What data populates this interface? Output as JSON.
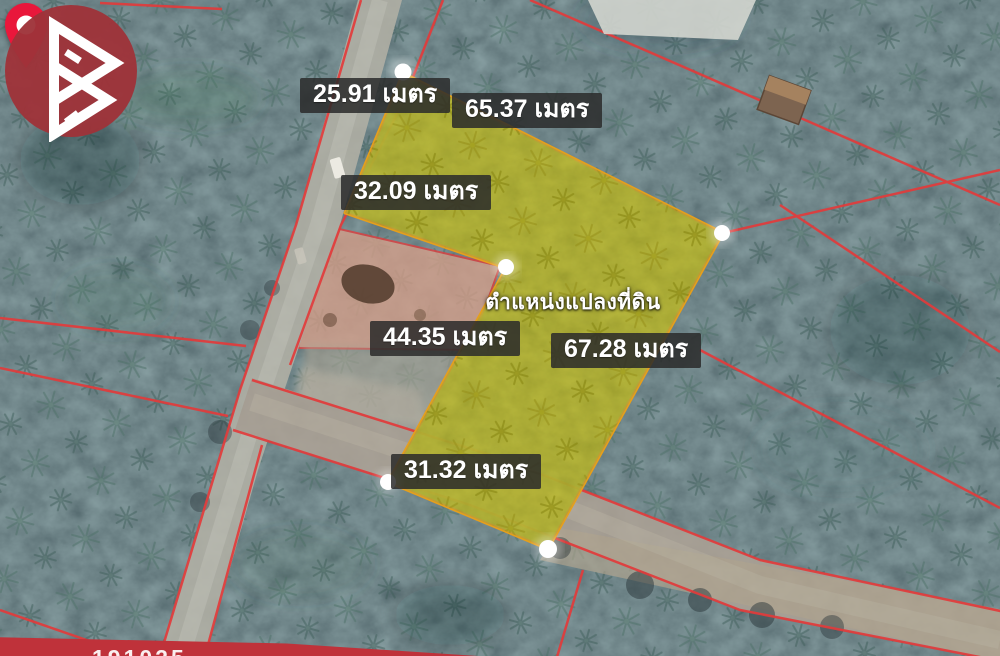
{
  "map": {
    "type_note": "satellite view of palm plantation with surveyed land plot overlay",
    "measurements": [
      {
        "edge": "upper-road-frontage",
        "text": "25.91 เมตร",
        "value": 25.91,
        "unit": "เมตร"
      },
      {
        "edge": "top-right",
        "text": "65.37 เมตร",
        "value": 65.37,
        "unit": "เมตร"
      },
      {
        "edge": "mid-road-frontage",
        "text": "32.09 เมตร",
        "value": 32.09,
        "unit": "เมตร"
      },
      {
        "edge": "lower-left",
        "text": "44.35 เมตร",
        "value": 44.35,
        "unit": "เมตร"
      },
      {
        "edge": "right",
        "text": "67.28 เมตร",
        "value": 67.28,
        "unit": "เมตร"
      },
      {
        "edge": "bottom",
        "text": "31.32 เมตร",
        "value": 31.32,
        "unit": "เมตร"
      }
    ],
    "pin_caption": "ตำแหน่งแปลงที่ดิน"
  },
  "banner": {
    "partial_text": "191025"
  },
  "icons": {
    "pin": "location-pin-icon",
    "logo": "brand-b-logo-icon",
    "vertex": "vertex-dot"
  },
  "colors": {
    "plot_fill": "#c4c414",
    "plot_border": "#e79f1b",
    "boundary_red": "#e23b3b",
    "pin_red": "#e9173b",
    "logo_red": "#9e3339",
    "banner_red": "#bf323a",
    "forest_dark": "#22333a",
    "road_grey": "#b4b1a6"
  }
}
